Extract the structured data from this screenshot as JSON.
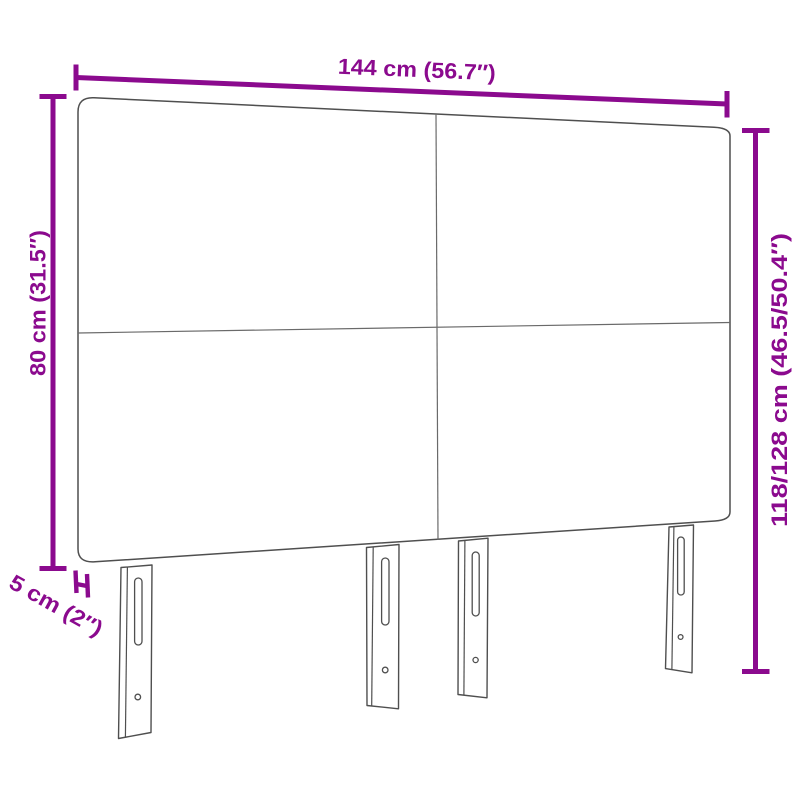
{
  "diagram": {
    "type": "product-dimension-diagram",
    "subject": "upholstered headboard with 4 panels and 4 height-adjustable legs",
    "background": "#ffffff",
    "colors": {
      "dimension_accent": "#8B0A8E",
      "line_art": "#4f4f4f"
    }
  },
  "dimensions": {
    "width": "144 cm (56.7″)",
    "panel_height": "80 cm (31.5″)",
    "total_height": "118/128 cm (46.5/50.4″)",
    "thickness": "5 cm (2″)"
  }
}
